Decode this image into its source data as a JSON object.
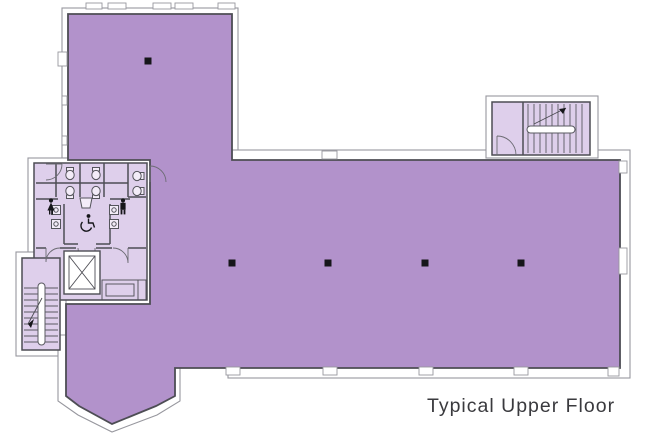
{
  "title": {
    "label": "Typical Upper Floor"
  },
  "colors": {
    "floor_main": "#b292cb",
    "floor_light": "#decfeb",
    "wall_line": "#4d4d54",
    "outer_line": "#97979e",
    "column": "#16161a",
    "text": "#3a3a3e",
    "background": "#ffffff"
  },
  "floor_plan": {
    "areas": [
      {
        "name": "open-plan-floor",
        "fill": "floor_main"
      },
      {
        "name": "restroom-core",
        "fill": "floor_light"
      },
      {
        "name": "lobby-closet",
        "fill": "floor_light"
      },
      {
        "name": "stairwell-southwest",
        "fill": "floor_light"
      },
      {
        "name": "stairwell-northeast",
        "fill": "floor_light"
      },
      {
        "name": "elevator-shaft",
        "fill": "white"
      }
    ],
    "columns": [
      {
        "x": 148,
        "y": 61
      },
      {
        "x": 232,
        "y": 263
      },
      {
        "x": 328,
        "y": 263
      },
      {
        "x": 425,
        "y": 263
      },
      {
        "x": 521,
        "y": 263
      }
    ],
    "fixtures": {
      "toilets": [
        {
          "x": 70,
          "y": 175,
          "tank": "top"
        },
        {
          "x": 96,
          "y": 175,
          "tank": "top"
        },
        {
          "x": 70,
          "y": 191,
          "tank": "bottom"
        },
        {
          "x": 96,
          "y": 191,
          "tank": "bottom"
        },
        {
          "x": 137,
          "y": 176,
          "tank": "right"
        },
        {
          "x": 137,
          "y": 191,
          "tank": "right"
        }
      ],
      "sinks": [
        {
          "x": 56,
          "y": 210
        },
        {
          "x": 56,
          "y": 224
        },
        {
          "x": 114,
          "y": 210
        },
        {
          "x": 114,
          "y": 224
        }
      ],
      "fountain": {
        "x": 86,
        "y": 202
      }
    },
    "icons": [
      {
        "name": "women-restroom-icon",
        "x": 51,
        "y": 207
      },
      {
        "name": "men-restroom-icon",
        "x": 123,
        "y": 207
      },
      {
        "name": "wheelchair-accessible-icon",
        "x": 87,
        "y": 223
      }
    ]
  }
}
